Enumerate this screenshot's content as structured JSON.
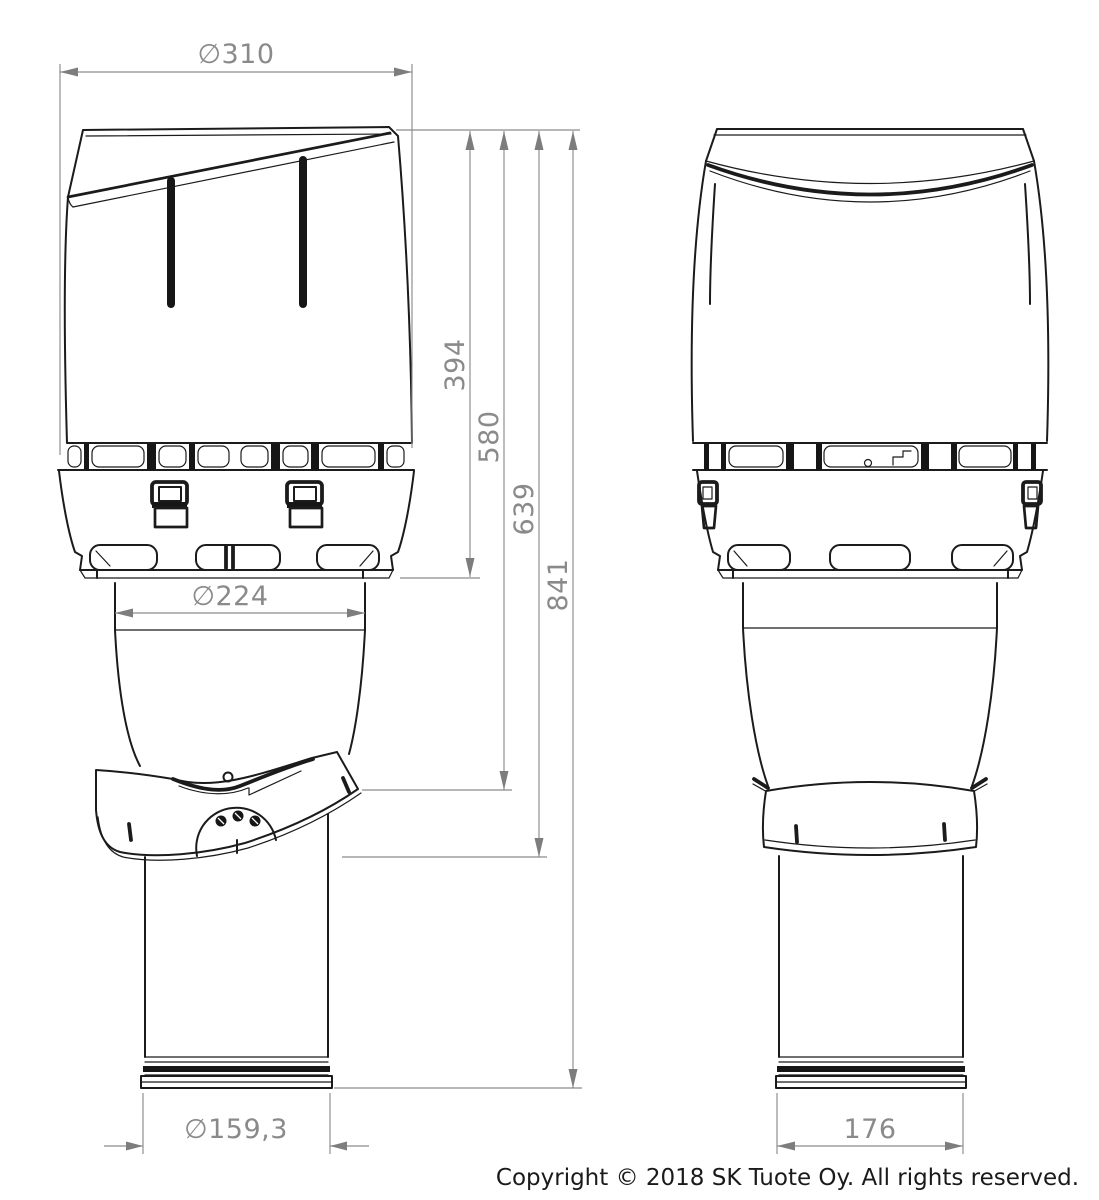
{
  "dimensions": {
    "cap_diameter": "∅310",
    "cap_height": "394",
    "height_to_seal_top": "580",
    "height_to_seal_bottom": "639",
    "total_height": "841",
    "adapter_diameter": "∅224",
    "pipe_diameter": "∅159,3",
    "side_pipe_width": "176"
  },
  "footer": {
    "copyright": "Copyright © 2018 SK Tuote Oy. All rights reserved."
  },
  "colors": {
    "drawing_line": "#1b1b1b",
    "dimension_line": "#8c8c8c",
    "dimension_text": "#8a8a8a",
    "background": "#ffffff"
  }
}
